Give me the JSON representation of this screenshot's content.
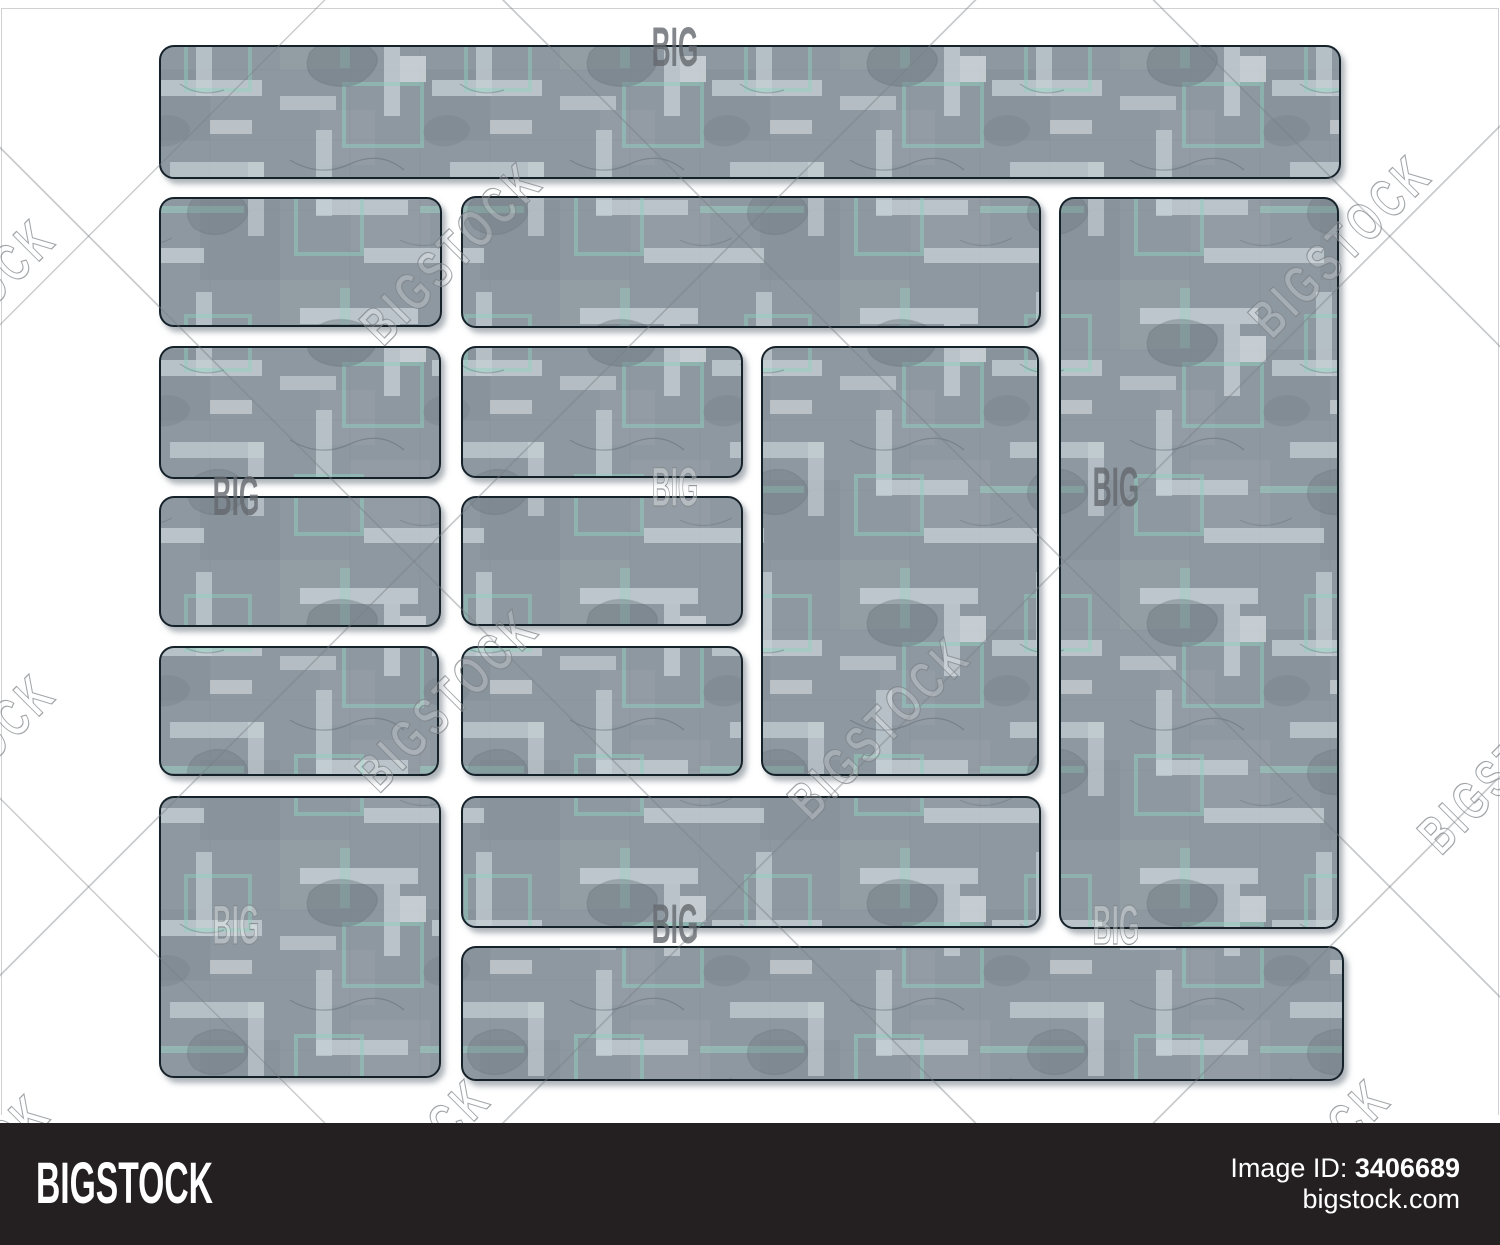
{
  "branding_bar": {
    "background": "#242021",
    "text_color": "#ffffff",
    "logo_text": "BIGSTOCK",
    "image_id_label": "Image ID:",
    "image_id_value": "3406689",
    "site_url": "bigstock.com"
  },
  "watermark": {
    "diagonal_text": "BIGSTOCK",
    "corner_text": "BIG",
    "line_color": "rgba(120,126,131,0.40)",
    "rotated_instances": [
      {
        "x": -35,
        "y": 310
      },
      {
        "x": 452,
        "y": 253
      },
      {
        "x": 1341,
        "y": 246
      },
      {
        "x": -35,
        "y": 765
      },
      {
        "x": 448,
        "y": 700
      },
      {
        "x": 880,
        "y": 728
      },
      {
        "x": 1510,
        "y": 762
      },
      {
        "x": 400,
        "y": 1170
      },
      {
        "x": 1300,
        "y": 1170
      },
      {
        "x": -40,
        "y": 1185
      }
    ],
    "big_instances": [
      {
        "x": 675,
        "y": 47,
        "style": "solid"
      },
      {
        "x": 236,
        "y": 496,
        "style": "solid"
      },
      {
        "x": 675,
        "y": 487,
        "style": "outline"
      },
      {
        "x": 1116,
        "y": 487,
        "style": "solid"
      },
      {
        "x": 236,
        "y": 925,
        "style": "outline"
      },
      {
        "x": 675,
        "y": 924,
        "style": "solid"
      },
      {
        "x": 1116,
        "y": 925,
        "style": "outline"
      }
    ]
  },
  "illustration": {
    "background": "#ffffff",
    "panel_base_color": "#8e98a0",
    "panel_light_strip_color": "#c7d1d6",
    "panel_accent_teal": "#98d1c1",
    "panel_border_color": "#17212b",
    "panel_corner_radius": 14,
    "panels": [
      {
        "name": "panel-header-banner",
        "x": 160,
        "y": 46,
        "w": 1180,
        "h": 132
      },
      {
        "name": "panel-row2-left",
        "x": 160,
        "y": 198,
        "w": 281,
        "h": 128
      },
      {
        "name": "panel-row2-center-banner",
        "x": 462,
        "y": 197,
        "w": 578,
        "h": 130
      },
      {
        "name": "panel-right-tall-column",
        "x": 1060,
        "y": 198,
        "w": 278,
        "h": 730
      },
      {
        "name": "panel-row3-left",
        "x": 160,
        "y": 347,
        "w": 280,
        "h": 131
      },
      {
        "name": "panel-row3-middle",
        "x": 462,
        "y": 347,
        "w": 280,
        "h": 130
      },
      {
        "name": "panel-center-tall-column",
        "x": 762,
        "y": 347,
        "w": 276,
        "h": 428
      },
      {
        "name": "panel-row4-left",
        "x": 160,
        "y": 497,
        "w": 280,
        "h": 129
      },
      {
        "name": "panel-row4-middle",
        "x": 462,
        "y": 497,
        "w": 280,
        "h": 128
      },
      {
        "name": "panel-row5-left",
        "x": 160,
        "y": 647,
        "w": 278,
        "h": 128
      },
      {
        "name": "panel-row5-middle",
        "x": 462,
        "y": 647,
        "w": 280,
        "h": 128
      },
      {
        "name": "panel-left-tall-block",
        "x": 160,
        "y": 797,
        "w": 280,
        "h": 280
      },
      {
        "name": "panel-row6-center-banner",
        "x": 462,
        "y": 797,
        "w": 578,
        "h": 130
      },
      {
        "name": "panel-bottom-banner",
        "x": 462,
        "y": 947,
        "w": 881,
        "h": 133
      }
    ]
  }
}
